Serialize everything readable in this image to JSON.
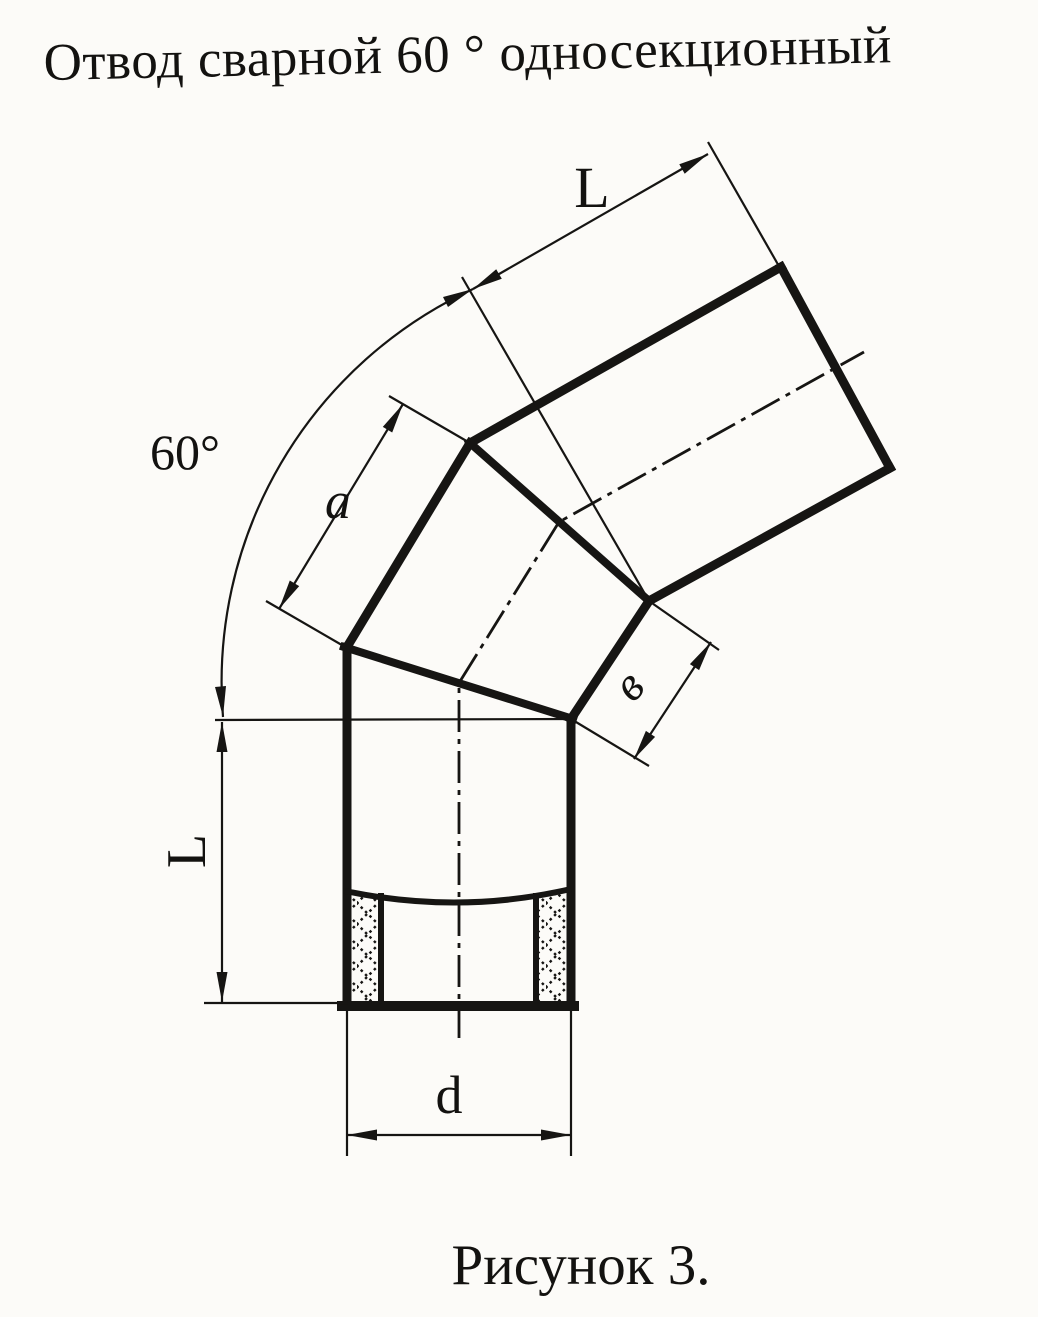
{
  "figure": {
    "title": "Отвод сварной 60 ° односекционный",
    "caption": "Рисунок 3.",
    "labels": {
      "length_top": "L",
      "angle": "60°",
      "section_edge_a": "a",
      "section_edge_b": "в",
      "length_left": "L",
      "diameter": "d"
    }
  }
}
